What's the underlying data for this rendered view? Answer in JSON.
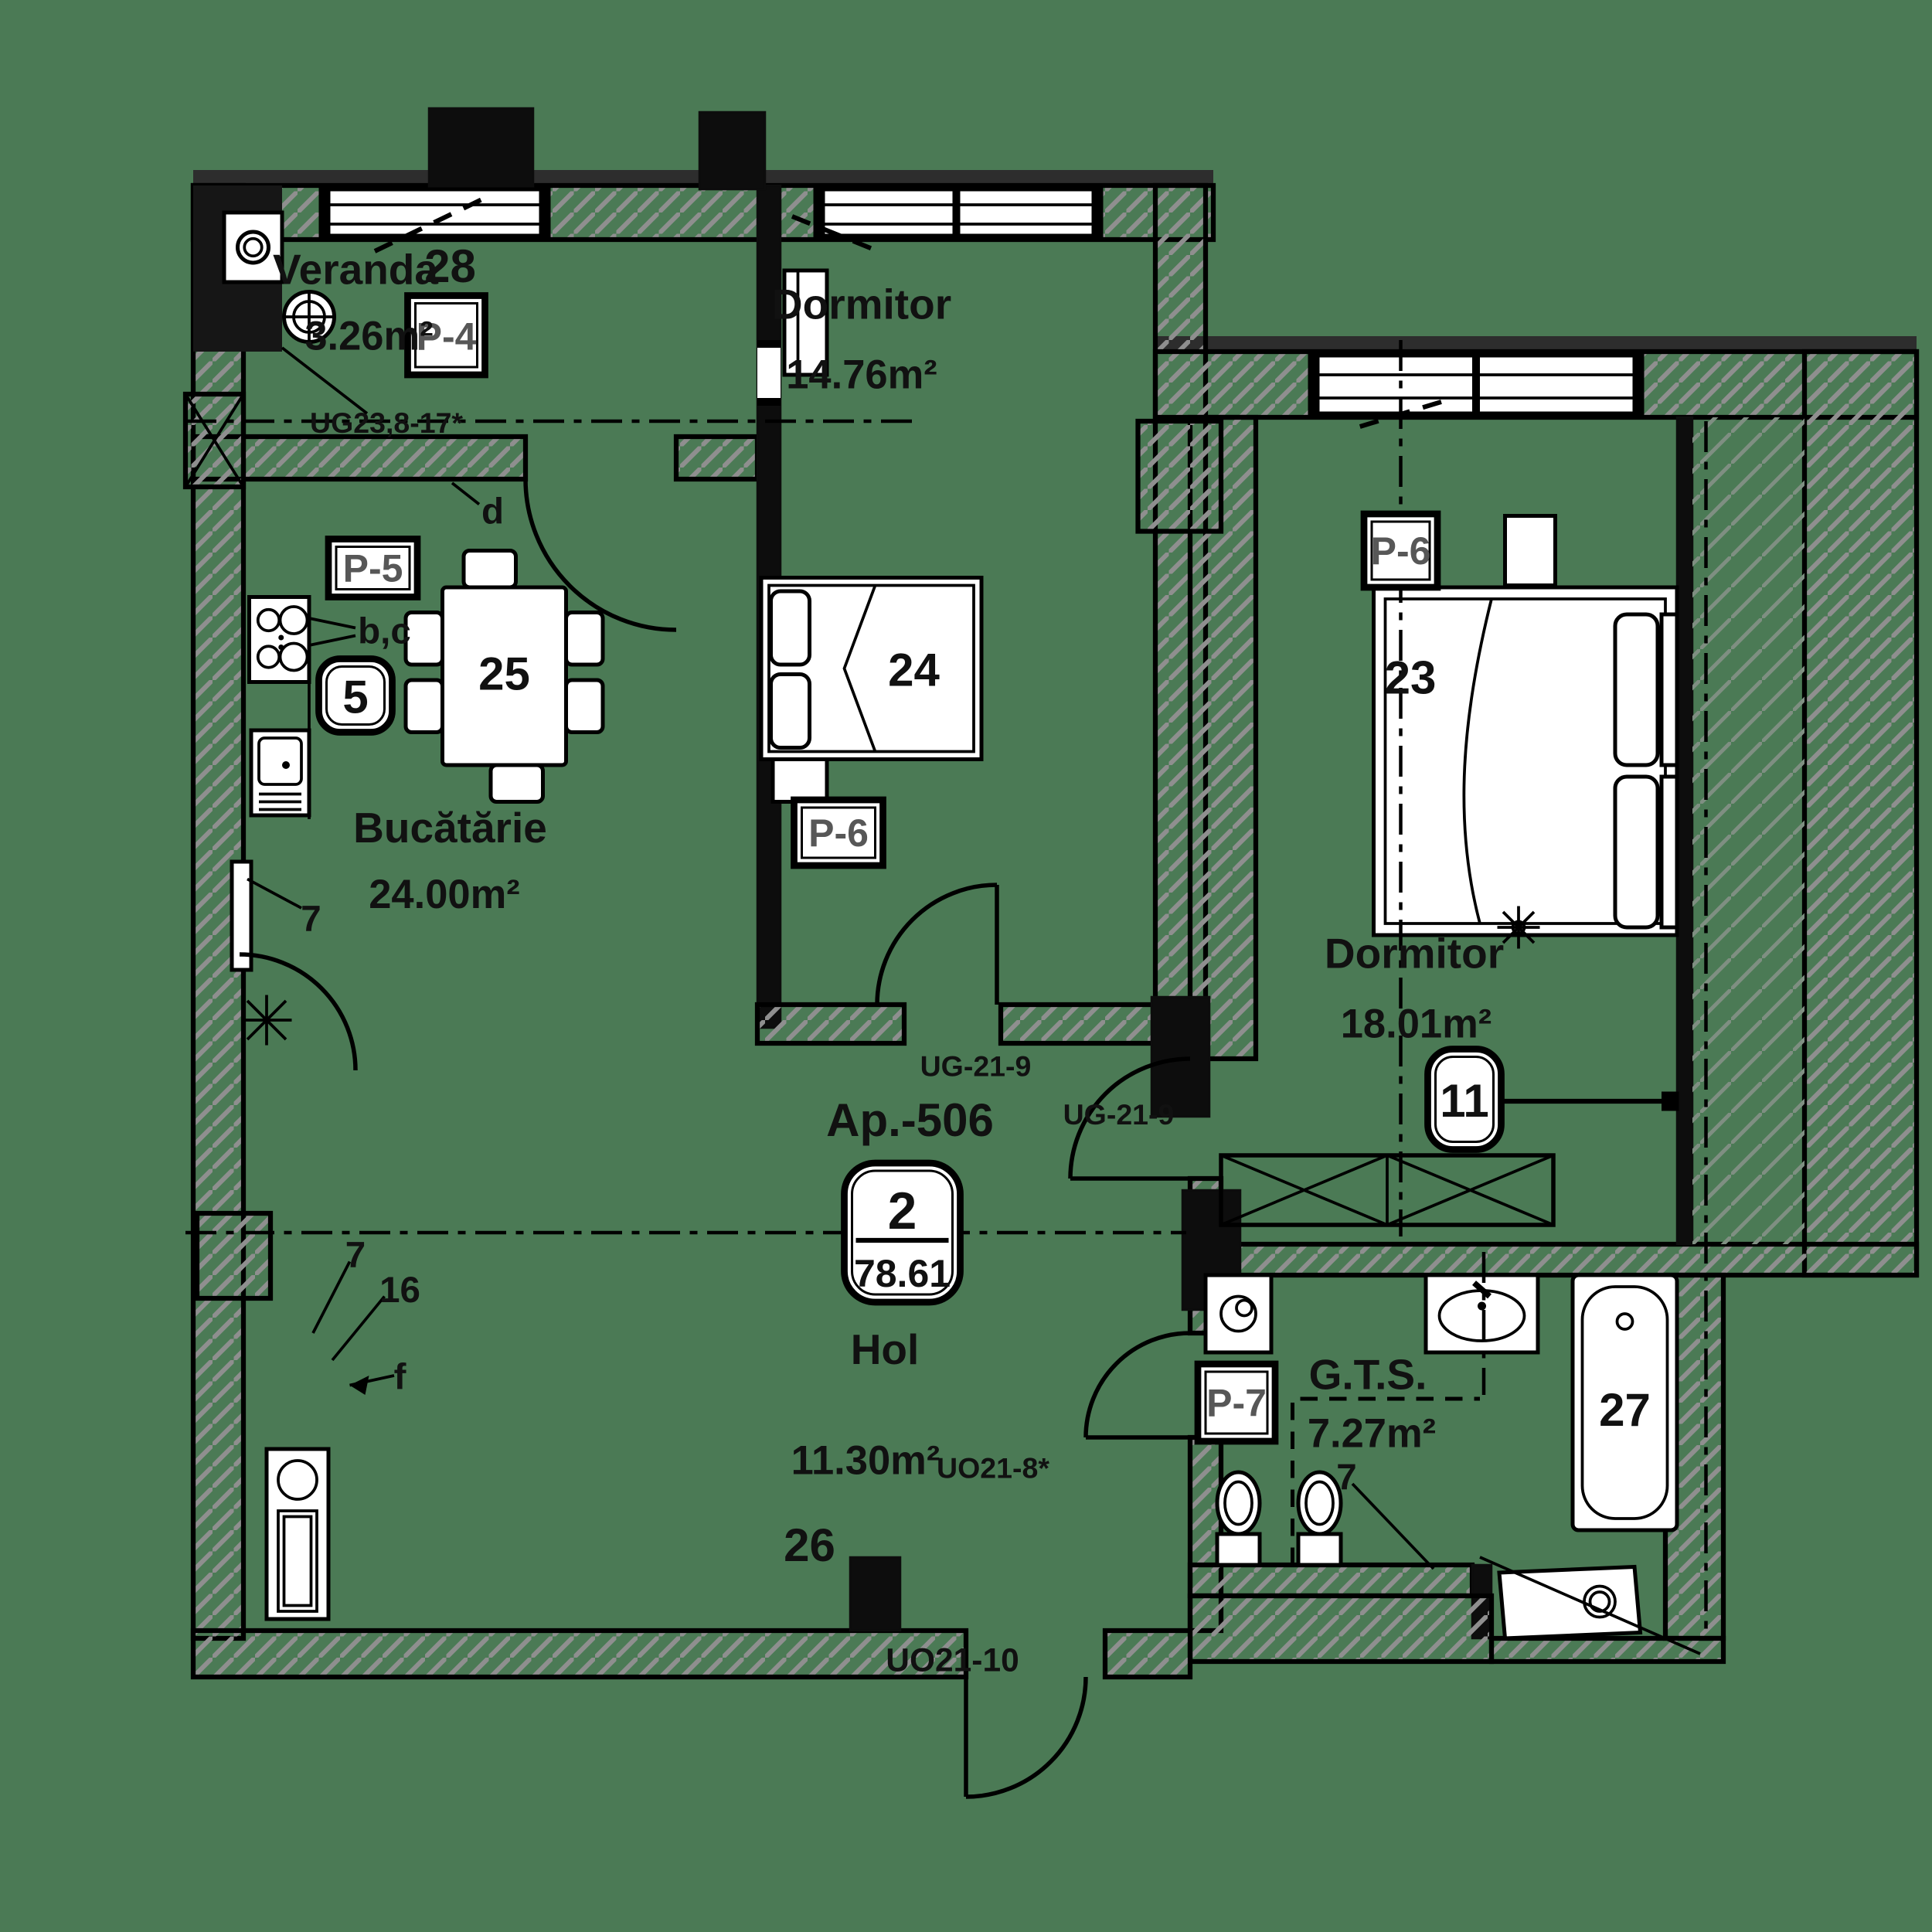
{
  "colors": {
    "background": "#4b7a55",
    "ink": "#111111",
    "hatch": "#8f8f8f",
    "panel_text": "#575757"
  },
  "apartment": {
    "label": "Ap.-506",
    "badge": {
      "rooms_count": "2",
      "total_area": "78.61"
    }
  },
  "rooms": {
    "veranda": {
      "name": "Veranda",
      "area": "3.26m²",
      "number": "28",
      "panel": "P-4"
    },
    "bedroom_top": {
      "name": "Dormitor",
      "area": "14.76m²",
      "number": "24",
      "panel": "P-6"
    },
    "bedroom_right": {
      "name": "Dormitor",
      "area": "18.01m²",
      "number": "23",
      "panel": "P-6",
      "heater_badge": "11"
    },
    "kitchen": {
      "name": "Bucătărie",
      "area": "24.00m²",
      "number": "25",
      "hob_badge": "5",
      "counter_label": "b,c",
      "panel": "P-5",
      "radiator_label": "7"
    },
    "hall": {
      "name": "Hol",
      "area": "11.30m²",
      "number": "26"
    },
    "bathroom": {
      "name": "G.T.S.",
      "area": "7.27m²",
      "number": "27",
      "panel": "P-7",
      "fixture_label": "7"
    }
  },
  "doors": {
    "veranda_kitchen": "UG23,8-17*",
    "bedroom_top_hall": "UG-21-9",
    "bedroom_right_hall": "UG-21-9",
    "bathroom_hall": "UO21-8*",
    "entrance": "UO21-10"
  },
  "markers": {
    "axis_d": "d",
    "boiler_7": "7",
    "boiler_16": "16",
    "boiler_f": "f"
  }
}
